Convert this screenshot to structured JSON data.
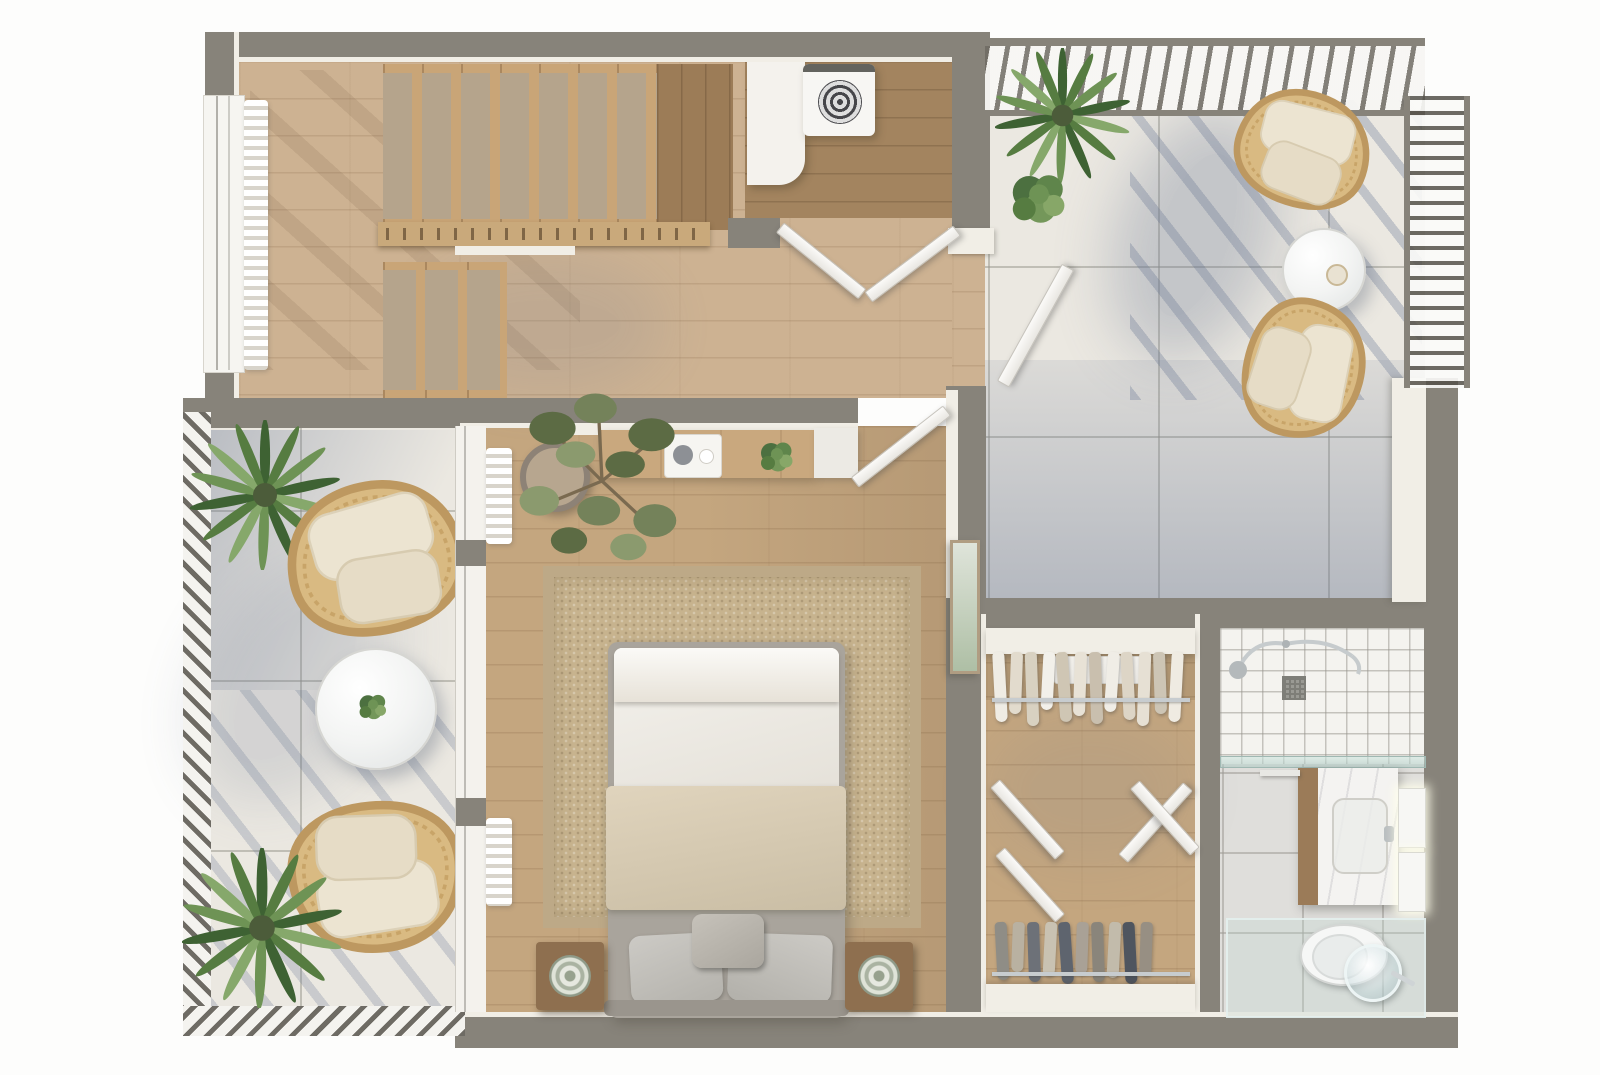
{
  "meta": {
    "kind": "3d-floor-plan-top-view",
    "width_px": 1600,
    "height_px": 1075,
    "visible_text": "none"
  },
  "palette": {
    "wall": "#87837a",
    "cream": "#f1eee6",
    "woodHall": "#cdb292",
    "woodBed": "#c4a67f",
    "woodUtil": "#a3845f",
    "woodLand": "#9c7c57",
    "woodStair": "#c9a577",
    "carpet": "#b5a48c",
    "tile": "#ebe8e1",
    "rug": "#c7b38e",
    "rugBorder": "#bda987",
    "duvet": "#f1efe9",
    "blanket": "#d9cbae",
    "pillow": "#c6c3bc",
    "bedframe": "#a9a49c",
    "wicker": "#d9ba82",
    "wickerEdge": "#bd9860",
    "cushion": "#ece4d1",
    "chrome": "#c7cccf",
    "railDark": "#6e6b64",
    "ledGlow": "#fffff0",
    "shadowBlue": "#6a7792",
    "plantGreens": "#3e6233 #567c41 #6e9355 #86a86b"
  },
  "rooms": [
    {
      "id": "staircase-hall",
      "floor": "light-oak-planks",
      "features": [
        "staircase-upper-flight-7-carpeted-treads",
        "upper-landing-dark-wood",
        "wood-railing-with-balusters",
        "staircase-lower-flight-3-carpeted-treads",
        "window-with-sheer-curtain"
      ]
    },
    {
      "id": "laundry-room",
      "floor": "dark-oak-planks",
      "features": [
        "white-l-counter",
        "top-load-washing-machine",
        "open-double-doors"
      ]
    },
    {
      "id": "roof-terrace",
      "floor": "cream-porcelain-tile",
      "features": [
        "pergola-slatted-top",
        "ladder-railing-right",
        "palm-plant",
        "shrub",
        "wicker-lounge-chair-north",
        "round-marble-side-table-with-cup",
        "wicker-lounge-chair-south",
        "cast-shadows",
        "door-from-hall"
      ]
    },
    {
      "id": "balcony",
      "floor": "cream-porcelain-tile",
      "features": [
        "hatched-railing-left",
        "hatched-railing-bottom",
        "palm-plant-north",
        "wicker-lounge-chair-north",
        "round-marble-coffee-table-with-plant",
        "wicker-lounge-chair-south",
        "palm-plant-south"
      ]
    },
    {
      "id": "bedroom",
      "floor": "oak-planks",
      "features": [
        "double-bed-white-duvet-beige-throw",
        "three-gray-pillows",
        "two-wood-nightstands-with-round-lamps",
        "jute-area-rug",
        "wall-desk-with-tray-and-plant",
        "olive-tree-in-pot",
        "glazed-window-wall-with-curtains",
        "leaning-artwork",
        "door-to-hall"
      ]
    },
    {
      "id": "walk-in-closet",
      "floor": "oak-planks",
      "features": [
        "upper-shelf",
        "upper-clothes-rail",
        "two-pairs-open-double-doors",
        "lower-clothes-rail",
        "lower-shelf"
      ]
    },
    {
      "id": "bathroom",
      "floor": "gray-tile",
      "features": [
        "walk-in-shower-white-grid-tile",
        "shower-fixtures",
        "square-drain",
        "glass-screen",
        "vanity-marble-top-wood-side",
        "towel-rail",
        "two-led-mirrors",
        "wall-hung-toilet",
        "round-glass-mirror",
        "glass-partition"
      ]
    }
  ],
  "staircase": {
    "upper_treads": 7,
    "lower_treads": 3,
    "runner": "beige-carpet"
  },
  "closet": {
    "top_rail_garments": [
      {
        "color": "#efece4",
        "h": 70,
        "r": -3
      },
      {
        "color": "#e2dbcd",
        "h": 62,
        "r": 2
      },
      {
        "color": "#d8d1c1",
        "h": 74,
        "r": -2
      },
      {
        "color": "#f2f0ea",
        "h": 58,
        "r": 3
      },
      {
        "color": "#cfc6b4",
        "h": 70,
        "r": -4
      },
      {
        "color": "#e8e2d6",
        "h": 64,
        "r": 2
      },
      {
        "color": "#c9bfae",
        "h": 72,
        "r": -2
      },
      {
        "color": "#f0ede6",
        "h": 60,
        "r": 4
      },
      {
        "color": "#ddd5c6",
        "h": 68,
        "r": -3
      },
      {
        "color": "#e6e0d4",
        "h": 74,
        "r": 2
      },
      {
        "color": "#cdc5b5",
        "h": 62,
        "r": -2
      },
      {
        "color": "#efebe2",
        "h": 70,
        "r": 3
      }
    ],
    "bottom_rail_garments": [
      {
        "color": "#8f8d86",
        "h": 58,
        "r": -3
      },
      {
        "color": "#b9b1a1",
        "h": 50,
        "r": 2
      },
      {
        "color": "#6d7178",
        "h": 60,
        "r": -2
      },
      {
        "color": "#c9c2b2",
        "h": 54,
        "r": 3
      },
      {
        "color": "#5e646e",
        "h": 62,
        "r": -4
      },
      {
        "color": "#a9a196",
        "h": 52,
        "r": 2
      },
      {
        "color": "#8a857b",
        "h": 60,
        "r": -2
      },
      {
        "color": "#c2bbab",
        "h": 56,
        "r": 3
      },
      {
        "color": "#4f555f",
        "h": 62,
        "r": -3
      },
      {
        "color": "#978f83",
        "h": 54,
        "r": 2
      }
    ]
  }
}
